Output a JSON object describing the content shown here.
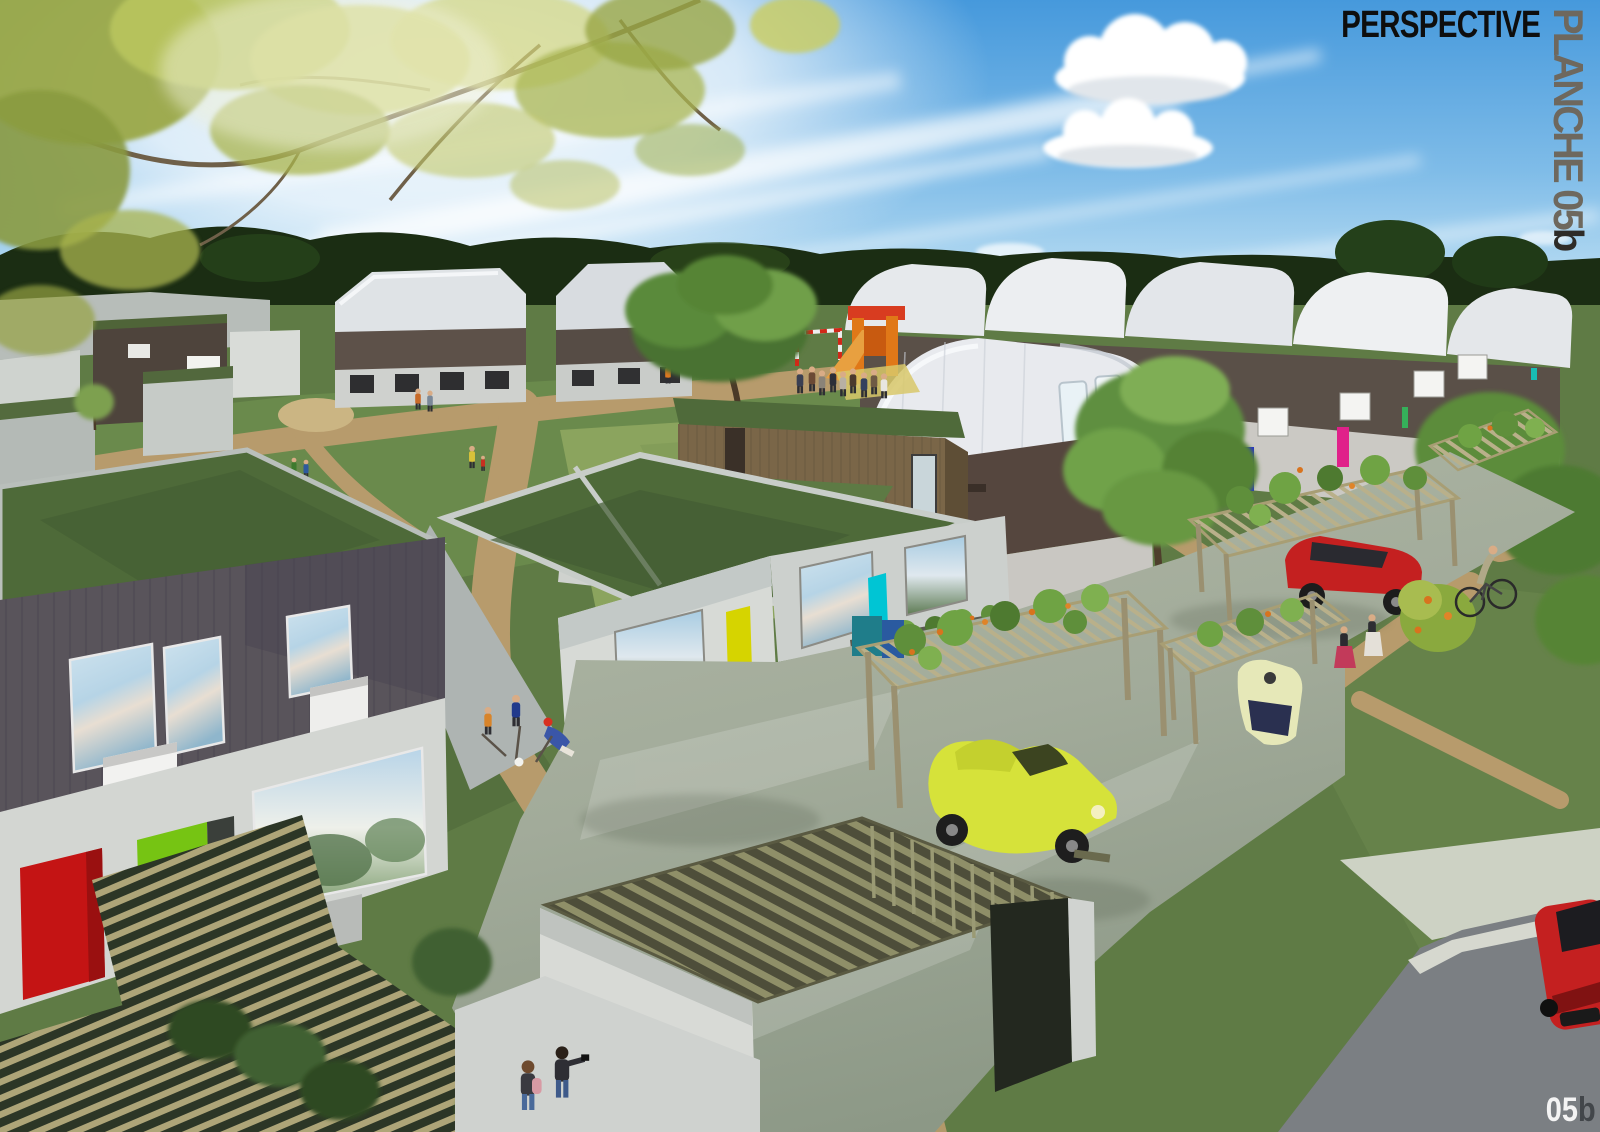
{
  "board": {
    "title": "PERSPECTIVE",
    "side_label": {
      "text": "PLANCHE 05",
      "suffix": "b"
    },
    "page_number": {
      "number": "05",
      "suffix": "b"
    }
  },
  "colors": {
    "title_text": "#0e0e0e",
    "side_label_text": "#6e685e",
    "side_label_suffix": "#2e2b27",
    "page_number_text": "#f4f4f4",
    "page_number_suffix": "#42464a",
    "sky_top": "#4699dc",
    "sky_horizon": "#e2f1f9",
    "treeline": "#1b2d13",
    "grass": "#5f7b45",
    "lawn_light": "#8ba45e",
    "sand_path": "#b79b6c",
    "green_roof": "#4e6a39",
    "barn_roof_white": "#e9ebee",
    "timber_cladding": "#7a6648",
    "dark_zinc_cladding": "#59545b",
    "white_wall": "#d3d6d3",
    "red_door": "#c41414",
    "green_door": "#76c413",
    "yellow_door": "#d6d400",
    "cyan_door": "#00c5d4",
    "magenta_accent": "#c813c8",
    "blue_accent": "#2531cc",
    "pink_accent": "#e0218a",
    "courtyard_paving": "#a2ab9a",
    "pergola_wood": "#b2a87e",
    "vine_green": "#5f8f3b",
    "vine_flower_orange": "#d8731e",
    "car_yellow": "#d6e23a",
    "car_red": "#c42020",
    "road_asphalt": "#7b7f83"
  },
  "scene": {
    "kind": "architectural-perspective-rendering",
    "elements": [
      "overhanging-tree-branches",
      "sky-with-cirrus-clouds",
      "tree-line-horizon",
      "curved-roof-houses",
      "green-roof-flat-houses",
      "timber-clad-house-with-roof-terrace",
      "zinc-clad-house-red-green-doors",
      "playground-slide",
      "football-goal",
      "resident-groups",
      "children-playing-street-hockey",
      "vine-covered-carport-pergolas",
      "yellow-citroen-2cv",
      "red-hatchback-under-pergola",
      "red-car-on-road",
      "cyclist",
      "pedestrians",
      "photographers",
      "timber-slat-carport",
      "timber-slat-ground-structure",
      "reflective-shared-courtyard",
      "sand-paths",
      "lawns",
      "asphalt-road"
    ]
  }
}
